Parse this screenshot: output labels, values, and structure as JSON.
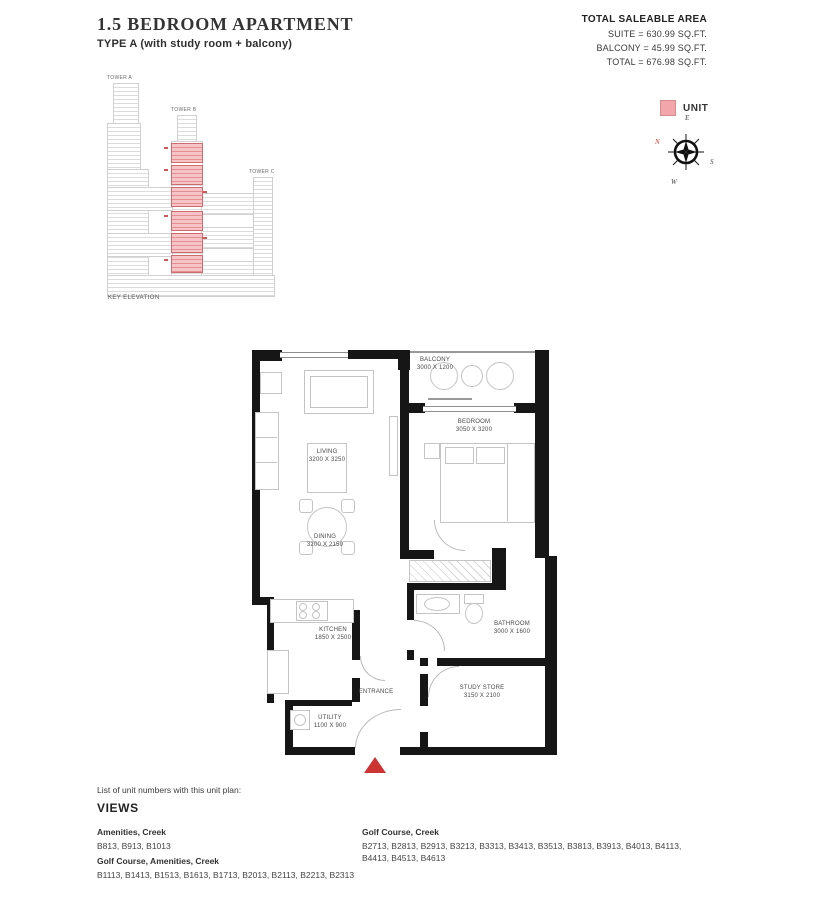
{
  "header": {
    "title": "1.5 BEDROOM APARTMENT",
    "subtitle": "TYPE A (with study room + balcony)",
    "area": {
      "heading": "TOTAL SALEABLE AREA",
      "suite": "SUITE = 630.99 SQ.FT.",
      "balcony": "BALCONY = 45.99 SQ.FT.",
      "total": "TOTAL = 676.98 SQ.FT."
    }
  },
  "legend": {
    "unit_label": "UNIT",
    "unit_color": "#f3a6aa"
  },
  "compass": {
    "n": "N",
    "e": "E",
    "s": "S",
    "w": "W"
  },
  "key_elevation": {
    "caption": "KEY ELEVATION",
    "tower_a": "TOWER A",
    "tower_b": "TOWER B",
    "tower_c": "TOWER C"
  },
  "floor_plan": {
    "entrance_label": "ENTRANCE",
    "rooms": [
      {
        "name": "BALCONY",
        "dims": "3000 X 1200"
      },
      {
        "name": "BEDROOM",
        "dims": "3050 X 3200"
      },
      {
        "name": "LIVING",
        "dims": "3200 X 3250"
      },
      {
        "name": "DINING",
        "dims": "3200 X 2150"
      },
      {
        "name": "KITCHEN",
        "dims": "1850 X 2500"
      },
      {
        "name": "BATHROOM",
        "dims": "3000 X 1600"
      },
      {
        "name": "STUDY STORE",
        "dims": "3150 X 2100"
      },
      {
        "name": "UTILITY",
        "dims": "1100 X 900"
      }
    ]
  },
  "unit_list": {
    "intro": "List of unit numbers with this unit plan:",
    "heading": "VIEWS",
    "groups": [
      {
        "view": "Amenities, Creek",
        "units": "B813, B913, B1013"
      },
      {
        "view": "Golf Course, Amenities, Creek",
        "units": "B1113, B1413, B1513, B1613, B1713, B2013, B2113, B2213, B2313"
      },
      {
        "view": "Golf Course, Creek",
        "units": "B2713, B2813, B2913, B3213, B3313, B3413, B3513, B3813, B3913, B4013, B4113, B4413, B4513, B4613"
      }
    ]
  }
}
